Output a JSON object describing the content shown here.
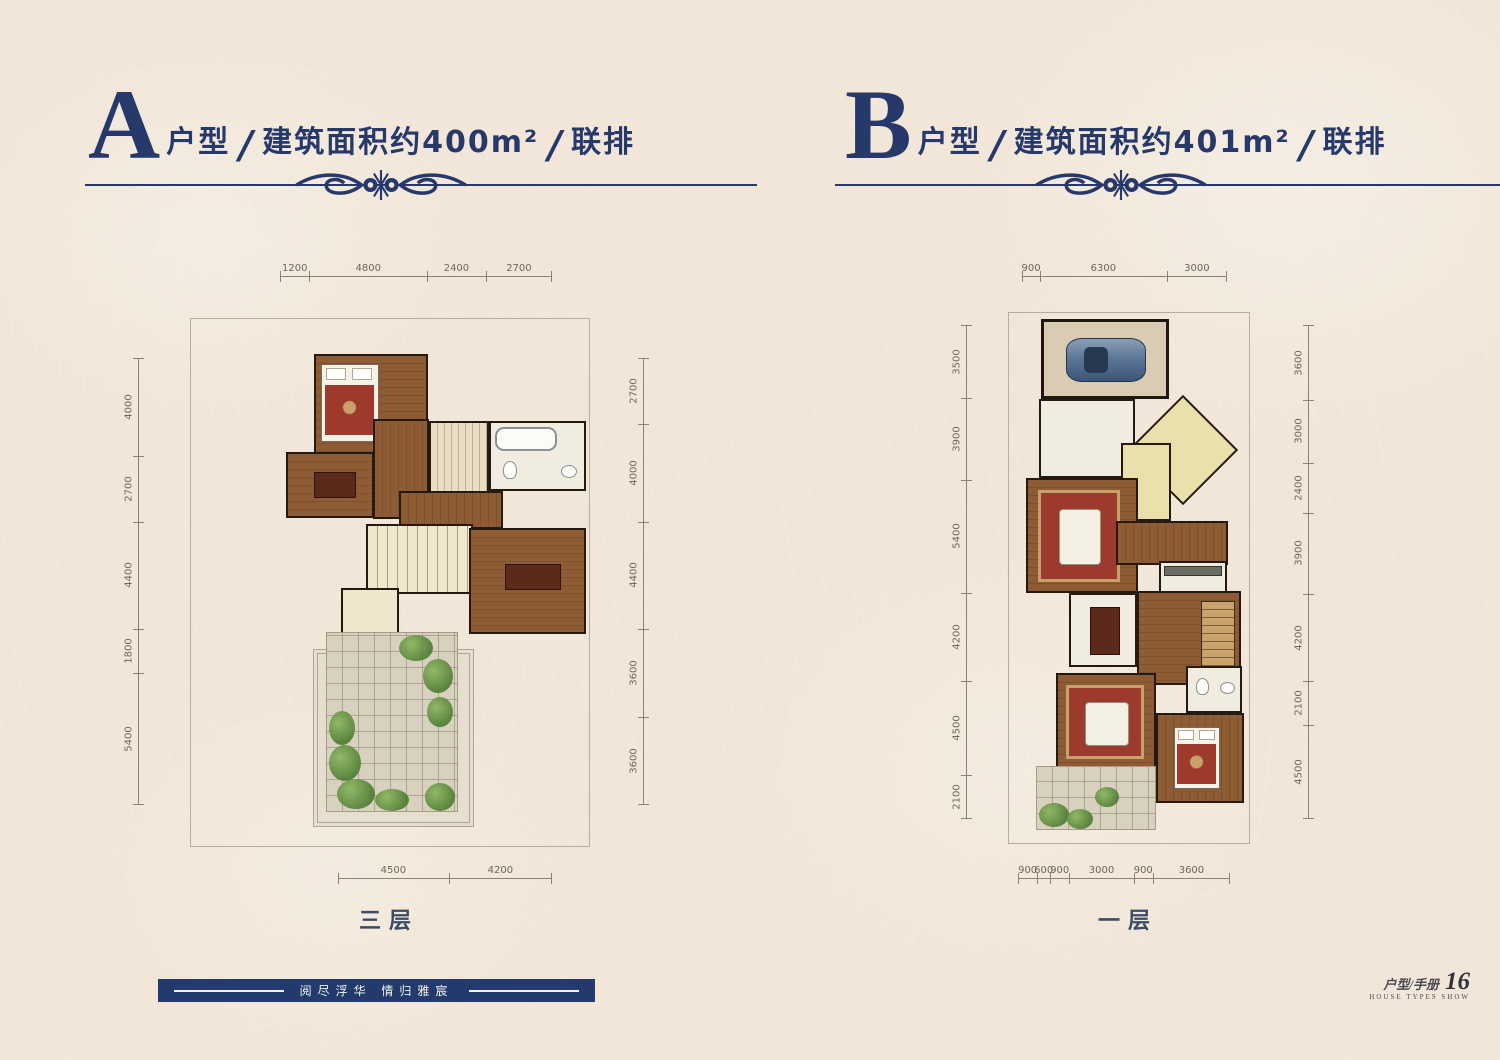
{
  "page": {
    "background": "#f1e6d8",
    "accent_navy": "#27386b",
    "wood_brown": "#8d5c35",
    "rug_red": "#9c3a2e",
    "pale_yellow": "#e9e0ac"
  },
  "panels": [
    {
      "letter": "A",
      "type_label": "户型",
      "separator": "/",
      "area_label": "建筑面积约400m²",
      "category_label": "联排",
      "floor_caption": "三层",
      "dims_top": [
        "1200",
        "4800",
        "2400",
        "2700"
      ],
      "dims_left": [
        "4000",
        "2700",
        "4400",
        "1800",
        "5400"
      ],
      "dims_right": [
        "2700",
        "4000",
        "4400",
        "3600",
        "3600"
      ],
      "dims_bottom": [
        "4500",
        "4200"
      ]
    },
    {
      "letter": "B",
      "type_label": "户型",
      "separator": "/",
      "area_label": "建筑面积约401m²",
      "category_label": "联排",
      "floor_caption": "一层",
      "dims_top": [
        "900",
        "6300",
        "3000"
      ],
      "dims_left": [
        "3500",
        "3900",
        "5400",
        "4200",
        "4500",
        "2100"
      ],
      "dims_right": [
        "3600",
        "3000",
        "2400",
        "3900",
        "4200",
        "2100",
        "4500"
      ],
      "dims_bottom": [
        "900",
        "600",
        "900",
        "3000",
        "900",
        "3600"
      ]
    }
  ],
  "footer": {
    "slogan": "阅尽浮华 情归雅宸",
    "handbook_cn": "户型/手册",
    "handbook_en": "HOUSE TYPES SHOW",
    "page_number": "16"
  }
}
